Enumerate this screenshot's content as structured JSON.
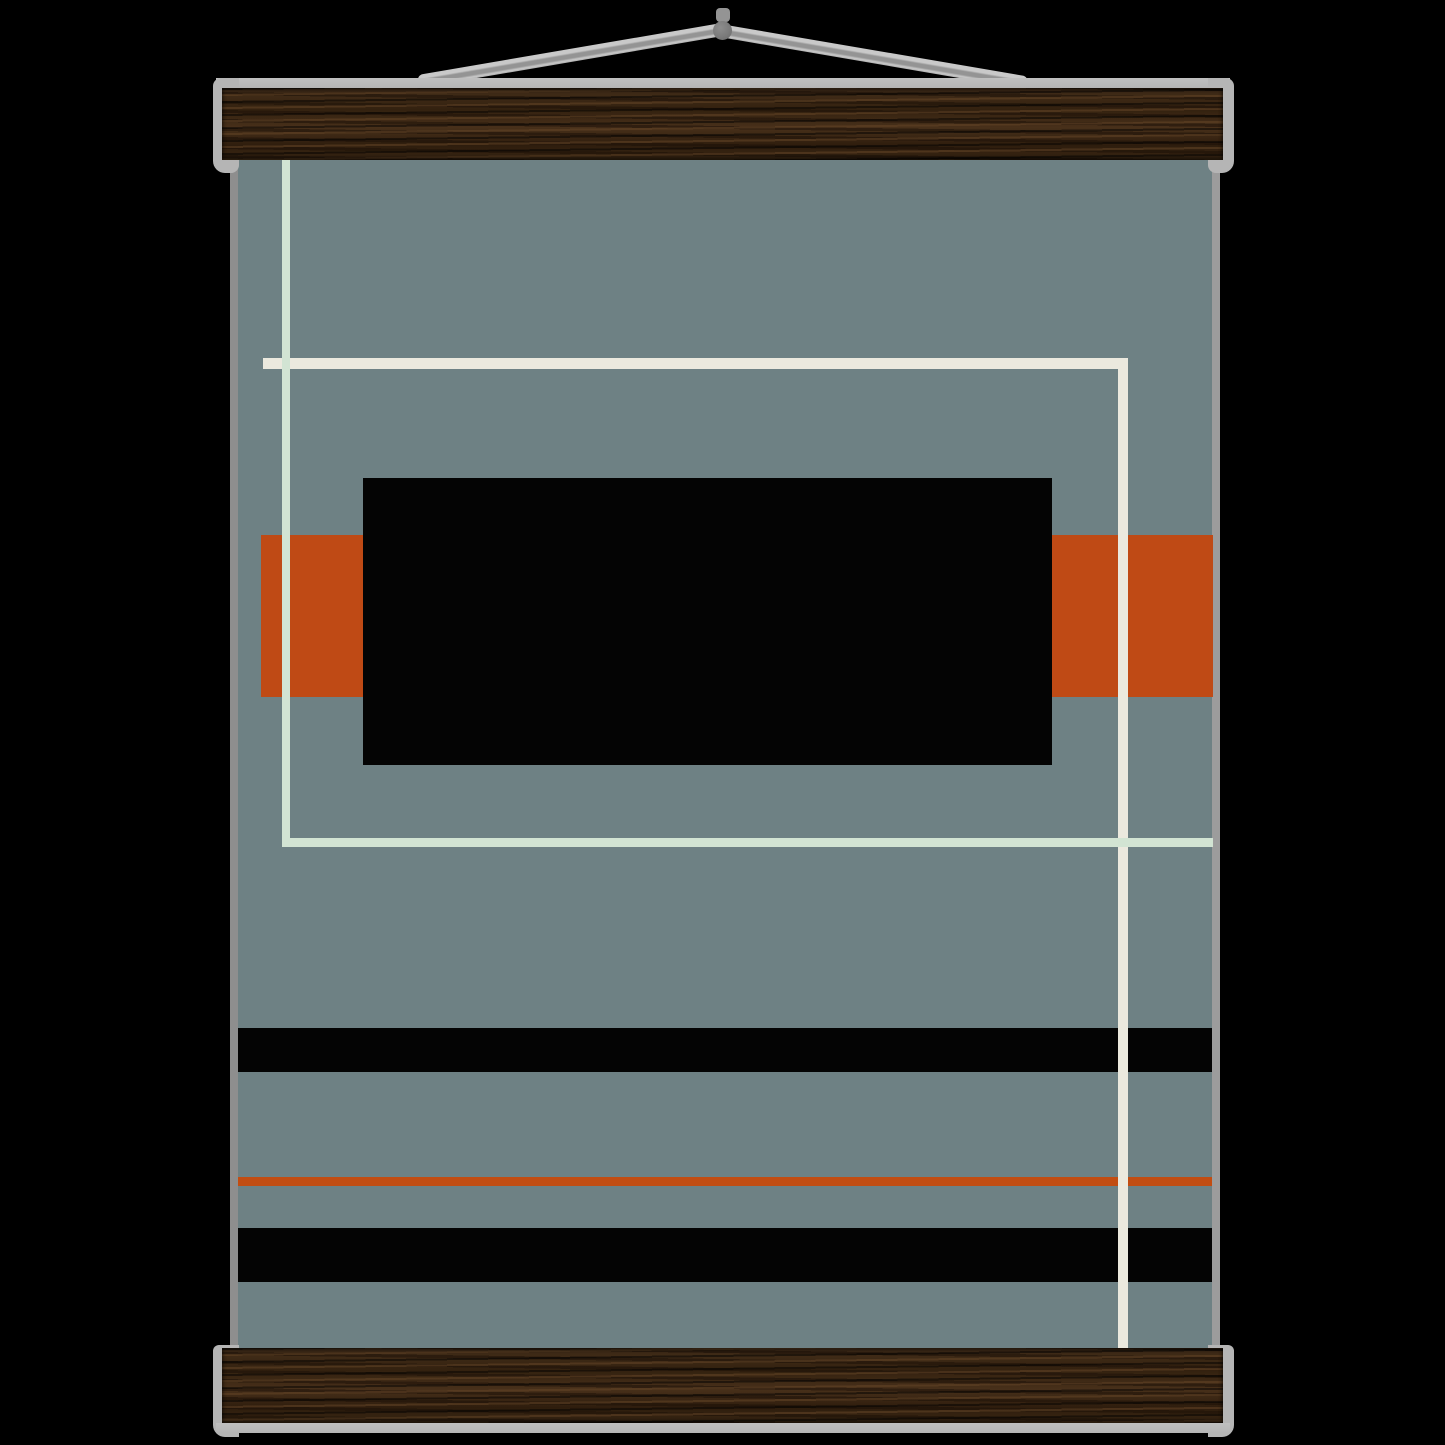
{
  "scene": {
    "description": "Abstract mid-century geometric art print hanging from dark wooden magnetic poster rails with a gray cord and nail on a black background",
    "background": "#000000"
  },
  "colors": {
    "canvas_bg": "#6e8184",
    "poster_edge_l": "#8e8e8e",
    "poster_edge_r": "#9c9c9c",
    "black_shape": "#040404",
    "orange": "#bf4a15",
    "orange_line": "#c24d12",
    "white_line": "#ebe9de",
    "mint_line": "#d2e4d3",
    "wood_mid": "#3a2715",
    "hanger_gray": "#b5b5b5",
    "string_gray": "#b0b0b0",
    "string_light": "#c9c9c9",
    "string_shade": "#949494",
    "nail_gray": "#7b7b7b"
  }
}
